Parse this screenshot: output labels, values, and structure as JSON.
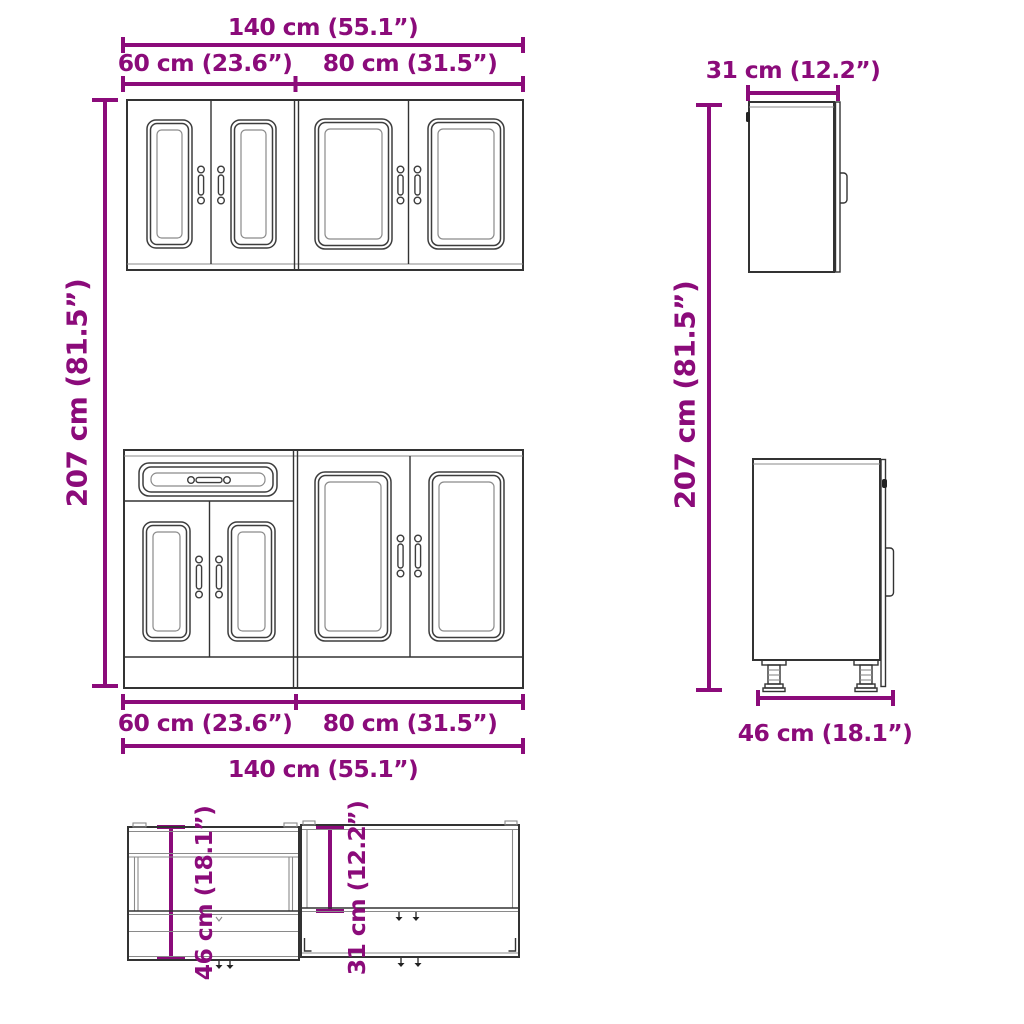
{
  "colors": {
    "dimension": "#8B0B7A",
    "line_dark": "#333333",
    "line_soft": "#8a8a8a",
    "background": "#ffffff"
  },
  "dimensions": {
    "width_total": "140 cm (55.1”)",
    "width_left": "60 cm (23.6”)",
    "width_right": "80 cm (31.5”)",
    "height_total": "207 cm (81.5”)",
    "depth_wall": "31 cm (12.2”)",
    "depth_base": "46 cm (18.1”)"
  }
}
